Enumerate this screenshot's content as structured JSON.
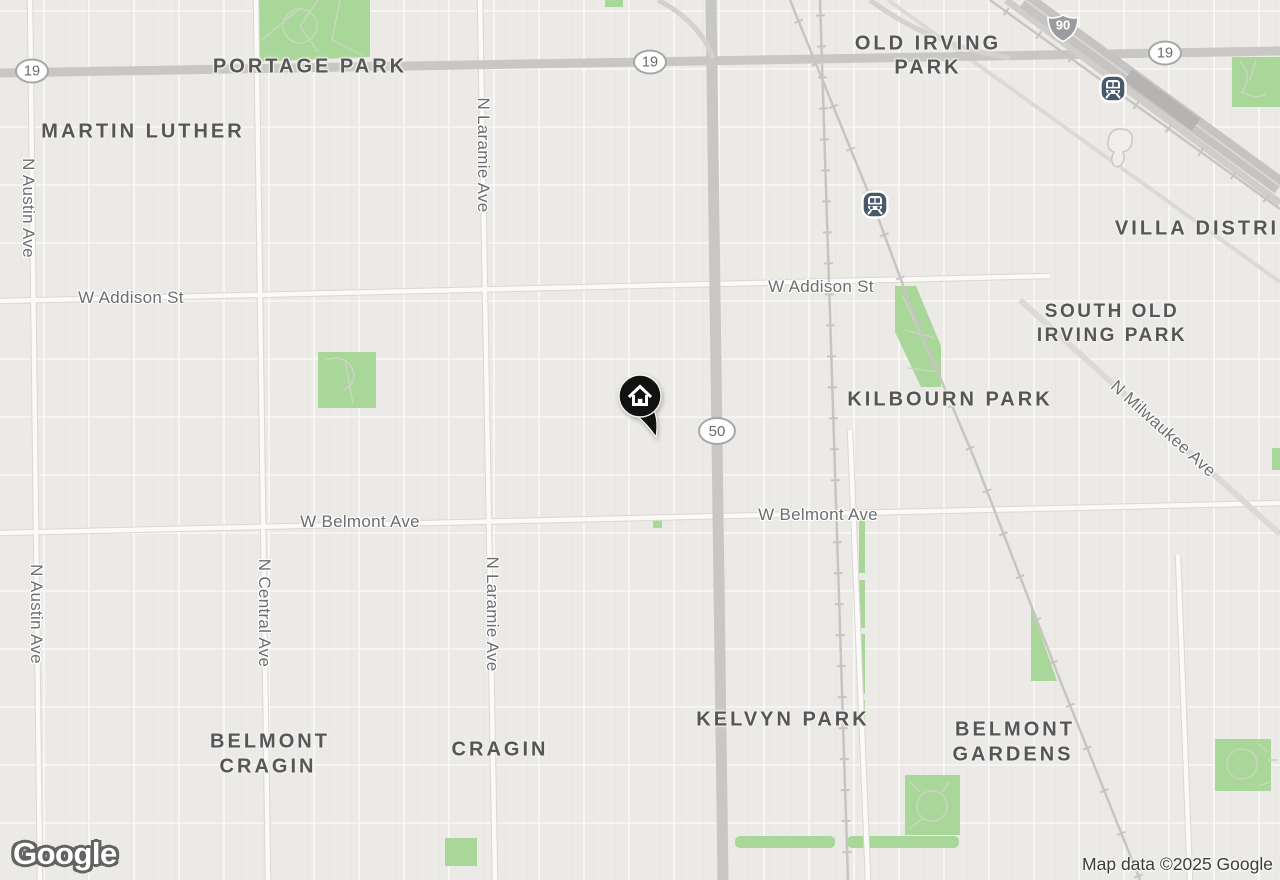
{
  "attribution": "Map data ©2025 Google",
  "logo_text": "Google",
  "marker": {
    "type": "home-location"
  },
  "colors": {
    "background": "#eceae6",
    "park_green": "#a9d79a",
    "road_major": "#c8c7c4",
    "expressway": "#c5c4c2",
    "railway": "#c7c5c2",
    "transit_icon": "#47596b",
    "marker": "#111111",
    "neighborhood_text": "#56565a",
    "street_text": "#6d6d71"
  },
  "neighborhood_labels": [
    {
      "text": "PORTAGE PARK"
    },
    {
      "text": "MARTIN LUTHER"
    },
    {
      "text": "OLD IRVING"
    },
    {
      "text": "PARK"
    },
    {
      "text": "VILLA DISTRI"
    },
    {
      "text": "SOUTH OLD"
    },
    {
      "text": "IRVING PARK"
    },
    {
      "text": "KILBOURN PARK"
    },
    {
      "text": "KELVYN PARK"
    },
    {
      "text": "BELMONT"
    },
    {
      "text": "GARDENS"
    },
    {
      "text": "BELMONT"
    },
    {
      "text": "CRAGIN"
    },
    {
      "text": "CRAGIN"
    }
  ],
  "street_labels": [
    {
      "text": "W Addison St"
    },
    {
      "text": "W Addison St"
    },
    {
      "text": "W Belmont Ave"
    },
    {
      "text": "W Belmont Ave"
    },
    {
      "text": "N Austin Ave"
    },
    {
      "text": "N Laramie Ave"
    },
    {
      "text": "N Austin Ave"
    },
    {
      "text": "N Central Ave"
    },
    {
      "text": "N Laramie Ave"
    },
    {
      "text": "N Milwaukee Ave"
    }
  ],
  "route_shields": [
    {
      "route": "19",
      "type": "state"
    },
    {
      "route": "19",
      "type": "state"
    },
    {
      "route": "19",
      "type": "state"
    },
    {
      "route": "50",
      "type": "state"
    },
    {
      "route": "90",
      "type": "interstate"
    }
  ],
  "transit_stations": [
    {
      "type": "train-station"
    },
    {
      "type": "train-station"
    }
  ]
}
